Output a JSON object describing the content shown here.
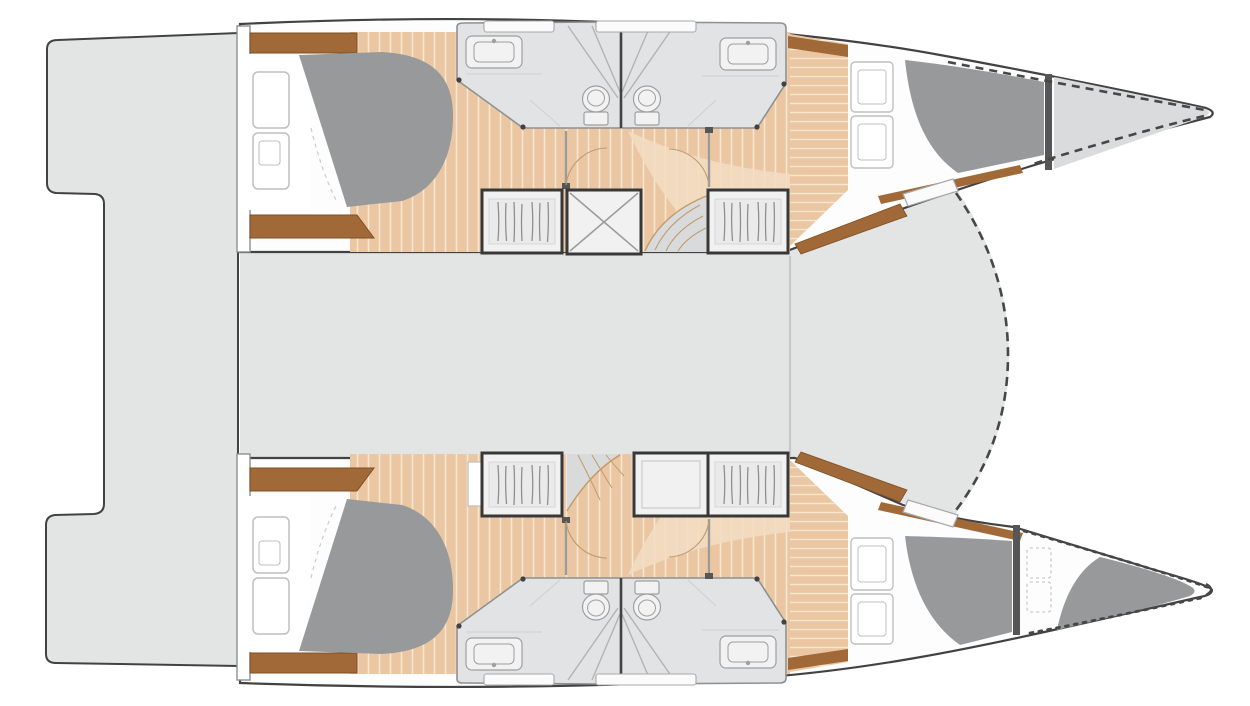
{
  "document": {
    "type": "catamaran-interior-deck-plan",
    "orientation": "bow-right",
    "text_labels": []
  },
  "colors": {
    "background": "#ffffff",
    "deck": "#e3e4e4",
    "deck_edge": "#8f9091",
    "foredeck": "#dadbdc",
    "hull_fill": "#fdfdfd",
    "outline": "#424242",
    "wood_floor": "#eac7a2",
    "wood_floor_light": "#f3ddc4",
    "plank_line": "#f7e6d0",
    "trim_brown": "#a06937",
    "trim_brown_dark": "#7e4f24",
    "bed_gray": "#97999b",
    "bedding_white": "#ffffff",
    "bedding_line": "#cccccc",
    "fixture_fill": "#e2e3e4",
    "fixture_light": "#f2f2f2",
    "fixture_line": "#9f9f9f",
    "glass_line": "#b3b3b3",
    "cabinet_fill": "#f1f1f1",
    "cabinet_inner": "#eaeaea",
    "cabinet_border": "#383838",
    "hatch_fill": "#fbfbfb",
    "hatch_line": "#a8a8a8",
    "locker_line": "#bfbfbf",
    "dash_line": "#474747",
    "step_line": "#c29a6d",
    "bulkhead_dark": "#565656"
  },
  "plan": {
    "center_areas": [
      "aft-platform",
      "saloon-deck",
      "foredeck"
    ],
    "hulls": [
      {
        "name": "upper-hull",
        "areas": [
          "aft-double-cabin",
          "bathroom-aft",
          "bathroom-forward",
          "corridor",
          "forward-double-cabin",
          "forepeak-locker"
        ],
        "furniture": [
          "double-berth",
          "storage-lockers",
          "hanging-locker",
          "x-storage-box",
          "companionway-steps",
          "toilet",
          "toilet",
          "washbasin",
          "washbasin",
          "shower",
          "deck-hatches",
          "crash-bulkhead"
        ]
      },
      {
        "name": "lower-hull",
        "areas": [
          "aft-double-cabin",
          "bathroom-aft",
          "bathroom-forward",
          "corridor",
          "forward-double-cabin",
          "forepeak-berth"
        ],
        "furniture": [
          "double-berth",
          "storage-lockers",
          "hanging-locker",
          "storage-box",
          "companionway-steps",
          "toilet",
          "toilet",
          "washbasin",
          "washbasin",
          "shower",
          "deck-hatches",
          "crash-bulkhead",
          "forepeak-berth"
        ]
      }
    ]
  }
}
